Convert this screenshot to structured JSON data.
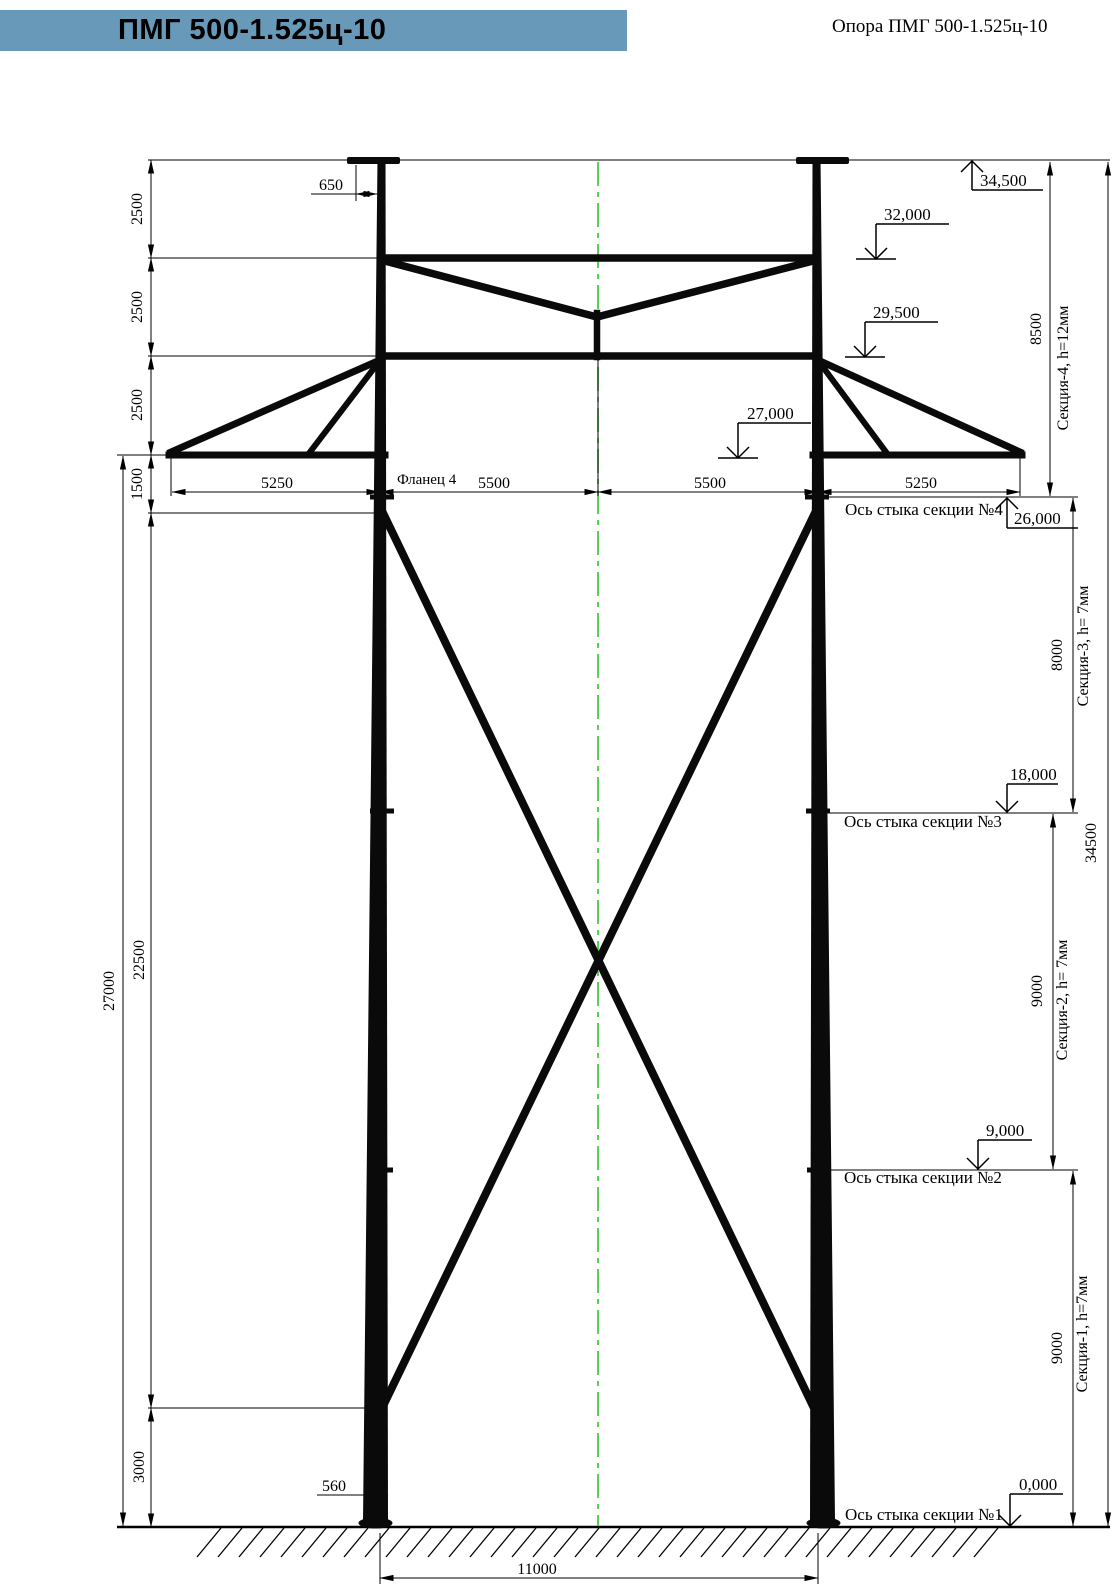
{
  "header": {
    "model": "ПМГ 500-1.525ц-10",
    "title": "Опора ПМГ 500-1.525ц-10"
  },
  "colors": {
    "banner": "#6899B8",
    "centerline": "#2FC52F",
    "line": "#000000"
  },
  "dimensions": {
    "top_offset": "650",
    "left_chain": [
      "2500",
      "2500",
      "2500",
      "1500",
      "22500",
      "3000"
    ],
    "left_total": "27000",
    "horizontal": [
      "5250",
      "5500",
      "5500",
      "5250"
    ],
    "base_width": "560",
    "base_span": "11000",
    "right_sections": [
      {
        "height": "8500",
        "label": "Секция-4, h=12мм"
      },
      {
        "height": "8000",
        "label": "Секция-3, h= 7мм"
      },
      {
        "height": "9000",
        "label": "Секция-2, h= 7мм"
      },
      {
        "height": "9000",
        "label": "Секция-1, h=7мм"
      }
    ],
    "right_total": "34500"
  },
  "elevations": [
    {
      "value": "34,500"
    },
    {
      "value": "32,000"
    },
    {
      "value": "29,500"
    },
    {
      "value": "27,000"
    },
    {
      "value": "26,000"
    },
    {
      "value": "18,000"
    },
    {
      "value": "9,000"
    },
    {
      "value": "0,000"
    }
  ],
  "annotations": {
    "flange": "Фланец 4",
    "joint_axes": [
      "Ось стыка секции №4",
      "Ось стыка секции №3",
      "Ось стыка секции №2",
      "Ось стыка секции №1"
    ]
  }
}
